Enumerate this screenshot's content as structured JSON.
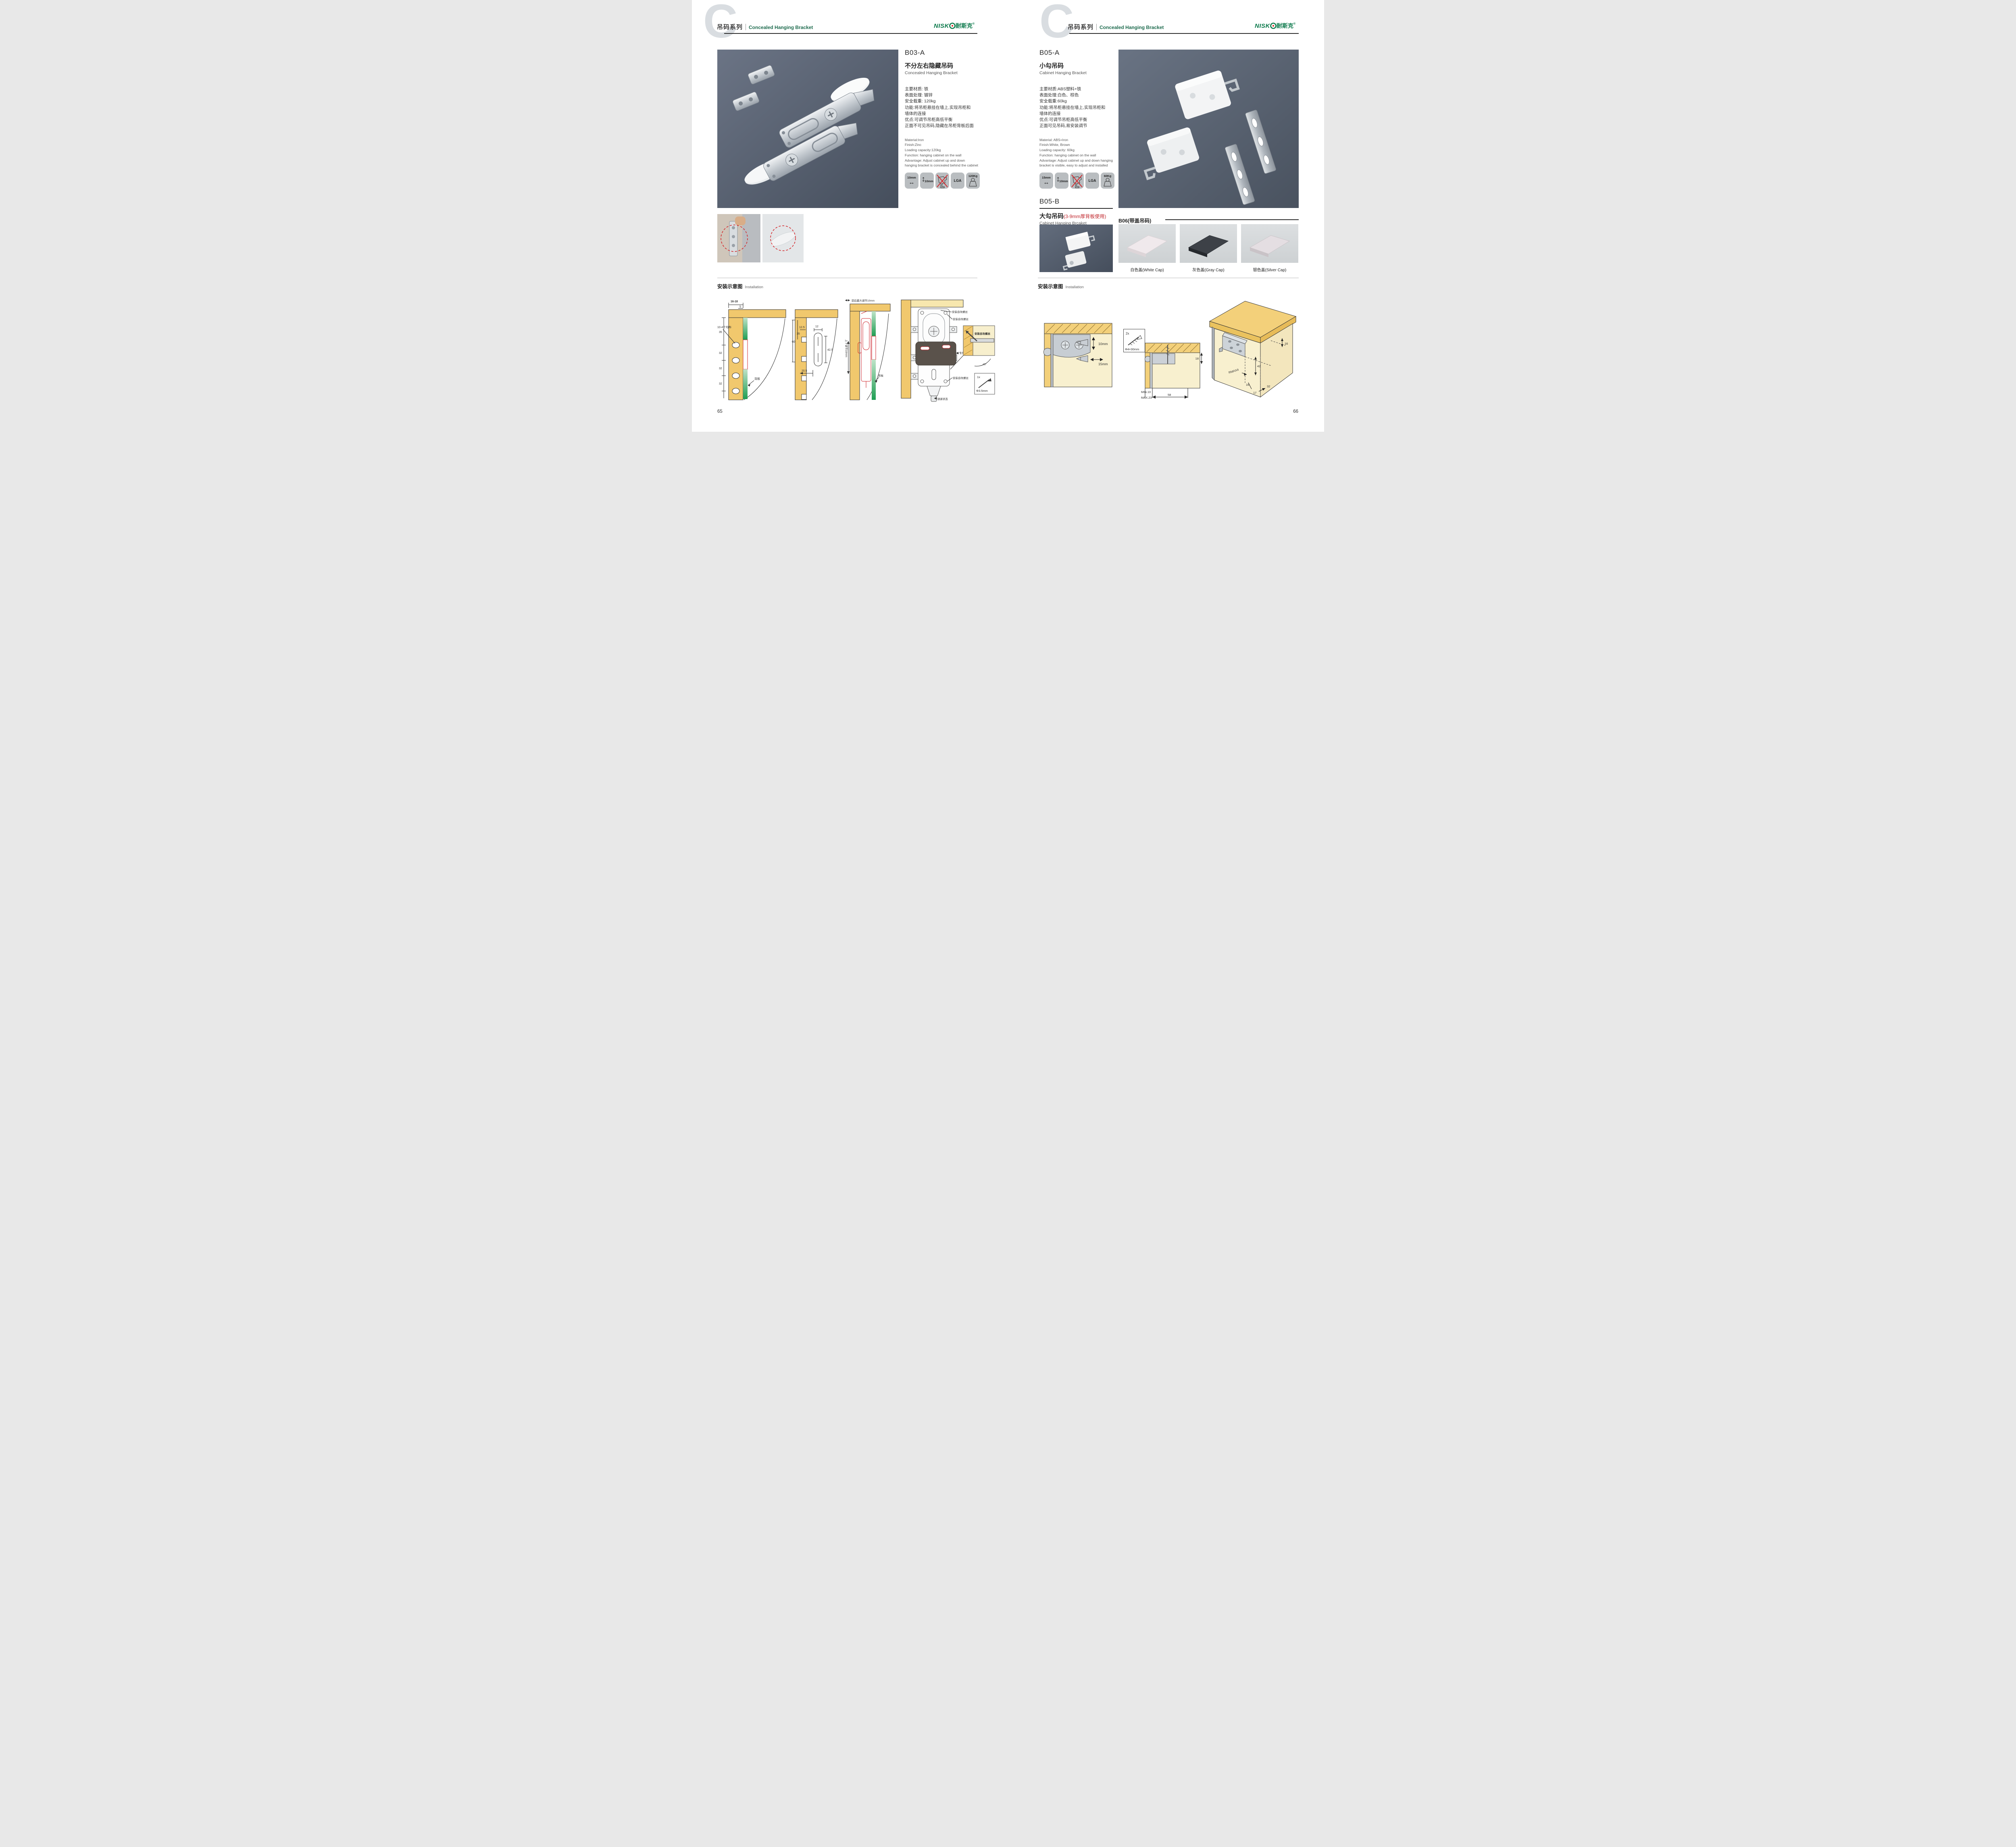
{
  "header": {
    "watermark": "C",
    "series_cn": "吊码系列",
    "series_en": "Concealed Hanging Bracket",
    "brand_latin": "NISK",
    "brand_cn": "耐斯克",
    "reg": "®"
  },
  "install": {
    "cn": "安装示意图",
    "en": "Installation"
  },
  "left": {
    "page_no": "65",
    "code": "B03-A",
    "name_cn": "不分左右隐藏吊码",
    "name_en": "Concealed Hanging Bracket",
    "specs_cn": [
      "主要材质: 铁",
      "表面处理: 镀锌",
      "安全载重: 120kg",
      "功能:将吊柜悬挂在墙上,实现吊柜和",
      "墙体的连接",
      "优点:可调节吊柜高低平衡",
      "正面不可见吊码,隐藏在吊柜背板后面"
    ],
    "specs_en": [
      "Material:Iron",
      "Finish:Zinc",
      "Loading capacity:120kg",
      "Function: hanging cabinet on the wall",
      "Advantage: Adjust cabinet up and down",
      "hanging bracket is concealed behind the cabinet"
    ],
    "icons": {
      "width": "10mm",
      "height": "10mm",
      "cert": "LGA",
      "load": "120Kg"
    },
    "d1": {
      "top": "16-18",
      "t5": "5",
      "v1": "35",
      "v2": "32",
      "v3": "32",
      "v4": "32",
      "holes": "10-4个均布",
      "back": "背板"
    },
    "d2": {
      "v60": "60",
      "v35": "35",
      "w125": "12.5",
      "w12": "12",
      "h425": "42.5",
      "w205": "20.5"
    },
    "d3": {
      "top": "前后最大调节10mm",
      "side": "上下调节10mm",
      "back": "背板"
    },
    "d4": {
      "screw": "安装自攻螺丝",
      "plate": "专用挂片",
      "lock": "锁紧状态",
      "angle": "45°",
      "qty": "1x",
      "dia": "Φ3.5mm"
    }
  },
  "right": {
    "page_no": "66",
    "code": "B05-A",
    "name_cn": "小勾吊码",
    "name_en": "Cabinet Hanging Bracket",
    "specs_cn": [
      "主要材质:ABS塑料+铁",
      "表面处理:白色、棕色",
      "安全载重:60kg",
      "功能:将吊柜悬挂在墙上,实现吊柜和",
      "墙体的连接",
      "优点:可调节吊柜高低平衡",
      "正面可见吊码,易安装调节"
    ],
    "specs_en": [
      "Material: ABS+Iron",
      "Finish:White, Brown",
      "Loading capacity: 60kg",
      "Function: hanging cabinet on the wall",
      "Advantage: Adjust cabinet up and down hanging",
      "bracket is visible, easy to adjust and installed"
    ],
    "icons": {
      "width": "15mm",
      "height": "10mm",
      "cert": "LGA",
      "load": "60Kg"
    },
    "b05b": {
      "code": "B05-B",
      "name_cn": "大勾吊码",
      "note": "(3-9mm厚背板使用)",
      "name_en": "Cabinet Hanging Brcaket"
    },
    "b06": {
      "heading": "B06(带盖吊码)",
      "caps": [
        "白色盖(White Cap)",
        "灰色盖(Gray Cap)",
        "银色盖(Silver Cap)"
      ]
    },
    "dr1": {
      "v": "10mm",
      "h": "15mm"
    },
    "screwbox": {
      "qty": "2x",
      "dia": "Φ4×30mm"
    },
    "dr2": {
      "d18": "18",
      "min": "MIN.10",
      "max": "MAX.23",
      "d58": "58"
    },
    "dr3": {
      "t16": "16",
      "d42": "42",
      "rmax": "RMAX4",
      "b16": "16",
      "b17": "17",
      "b32": "32"
    }
  }
}
